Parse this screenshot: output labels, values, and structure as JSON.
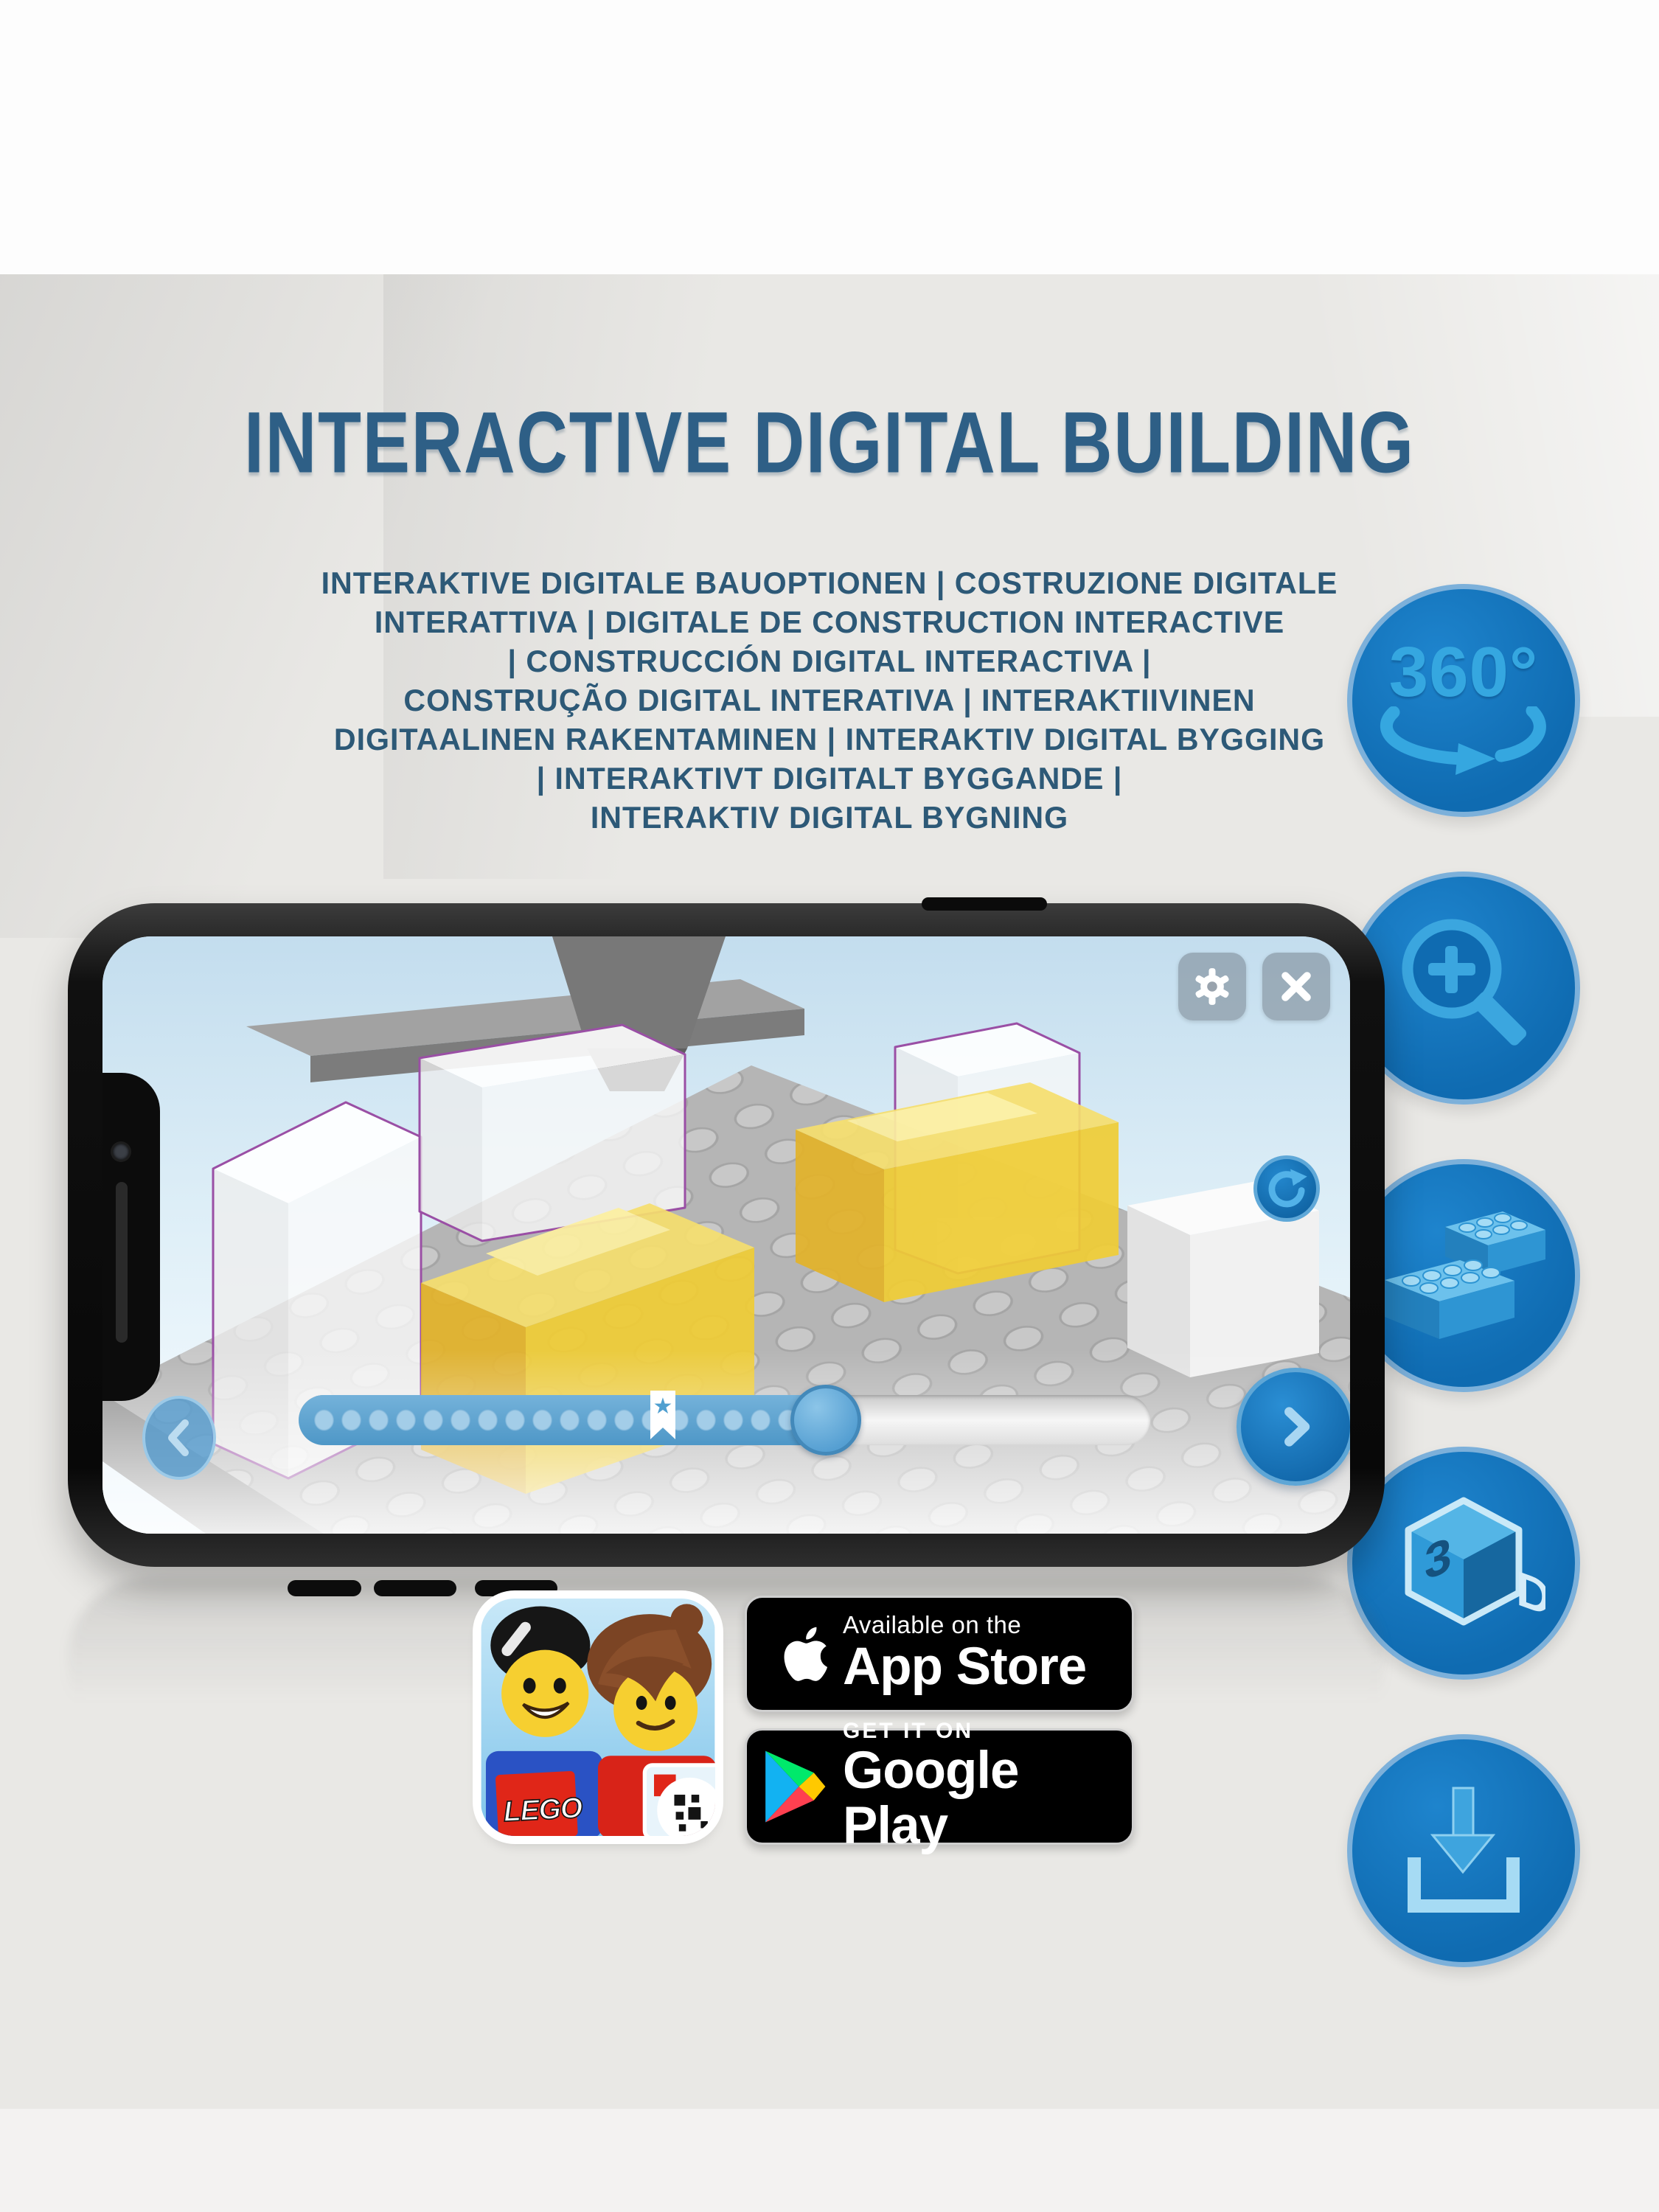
{
  "page": {
    "background": "#e9e8e5",
    "top_band": "#fdfdfd"
  },
  "header": {
    "title": "INTERACTIVE DIGITAL BUILDING",
    "color": "#2e5f86"
  },
  "subtitle": {
    "color": "#2d5977",
    "lines": [
      "INTERAKTIVE DIGITALE BAUOPTIONEN | COSTRUZIONE DIGITALE",
      "INTERATTIVA | DIGITALE DE CONSTRUCTION INTERACTIVE",
      "| CONSTRUCCIÓN DIGITAL INTERACTIVA |",
      "CONSTRUÇÃO DIGITAL INTERATIVA | INTERAKTIIVINEN",
      "DIGITAALINEN RAKENTAMINEN | INTERAKTIV DIGITAL BYGGING",
      "| INTERAKTIVT DIGITALT BYGGANDE |",
      "INTERAKTIV DIGITAL BYGNING"
    ]
  },
  "features": {
    "accent_color": "#1273bb",
    "ring_color": "#7cb0da",
    "glyph_color": "#35a7e0",
    "rotate360": {
      "label": "360°",
      "icon": "rotate-360-icon"
    },
    "zoom": {
      "icon": "zoom-in-icon"
    },
    "brick": {
      "icon": "brick-icon"
    },
    "view3d": {
      "icon": "3d-cube-icon",
      "left_char": "3",
      "right_char": "D"
    },
    "download": {
      "icon": "download-icon"
    }
  },
  "phone": {
    "app": {
      "progress": {
        "percent": 63,
        "bookmark_percent": 43,
        "star": "★"
      },
      "scene_colors": {
        "ghost_outline": "#9a4fa5",
        "piece_yellow": "#f0cd35",
        "plate_gray": "#b5b5b5"
      }
    }
  },
  "badges": {
    "lego_app_icon": {
      "logo_text": "LEGO"
    },
    "app_store": {
      "line1": "Available on the",
      "line2": "App Store"
    },
    "google_play": {
      "line1": "GET IT ON",
      "line2": "Google Play"
    }
  }
}
